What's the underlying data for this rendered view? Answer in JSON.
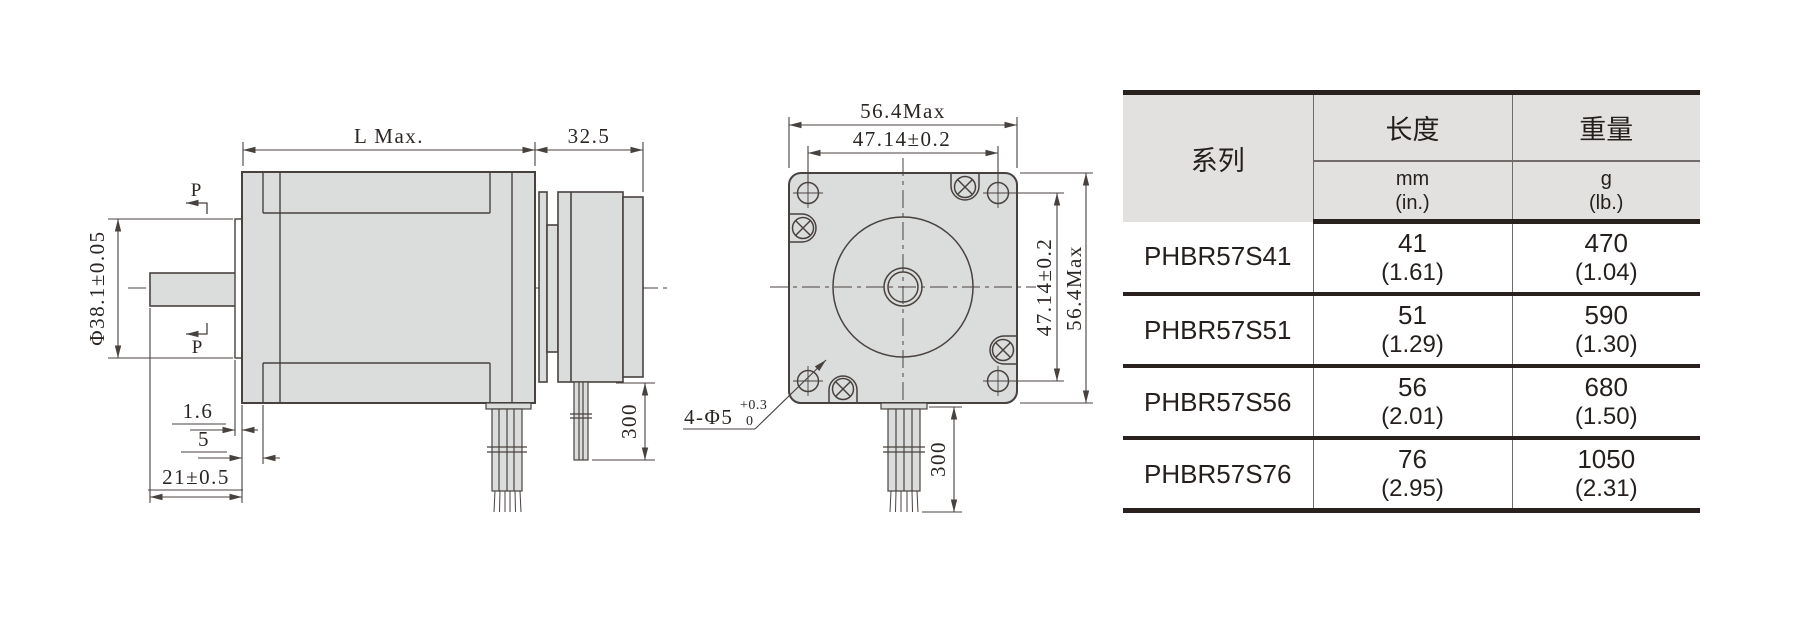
{
  "side_view": {
    "dim_length": "L Max.",
    "dim_brake_length": "32.5",
    "dim_pilot_diameter": "Φ38.1±0.05",
    "dim_pilot_height": "1.6",
    "dim_face_step": "5",
    "dim_shaft_length": "21±0.5",
    "dim_lead_length": "300",
    "section_marker": "P"
  },
  "front_view": {
    "dim_width_overall": "56.4Max",
    "dim_hole_pitch_h": "47.14±0.2",
    "dim_hole_pitch_v": "47.14±0.2",
    "dim_height_overall": "56.4Max",
    "dim_lead_length": "300",
    "hole_callout": "4-Φ5",
    "hole_callout_tol_upper": "+0.3",
    "hole_callout_tol_lower": "0"
  },
  "table": {
    "col_series": "系列",
    "col_length": "长度",
    "col_weight": "重量",
    "unit_length_main": "mm",
    "unit_length_sub": "(in.)",
    "unit_weight_main": "g",
    "unit_weight_sub": "(lb.)",
    "rows": [
      {
        "series": "PHBR57S41",
        "length_mm": "41",
        "length_in": "(1.61)",
        "weight_g": "470",
        "weight_lb": "(1.04)"
      },
      {
        "series": "PHBR57S51",
        "length_mm": "51",
        "length_in": "(1.29)",
        "weight_g": "590",
        "weight_lb": "(1.30)"
      },
      {
        "series": "PHBR57S56",
        "length_mm": "56",
        "length_in": "(2.01)",
        "weight_g": "680",
        "weight_lb": "(1.50)"
      },
      {
        "series": "PHBR57S76",
        "length_mm": "76",
        "length_in": "(2.95)",
        "weight_g": "1050",
        "weight_lb": "(2.31)"
      }
    ]
  },
  "colors": {
    "drawing_fill": "#dbdcdc",
    "drawing_line": "#48423f",
    "table_thick_rule": "#28211e",
    "table_thin_rule": "#716b69",
    "table_header_fill": "#e2e1df",
    "text": "#2b2623",
    "background": "#ffffff"
  }
}
